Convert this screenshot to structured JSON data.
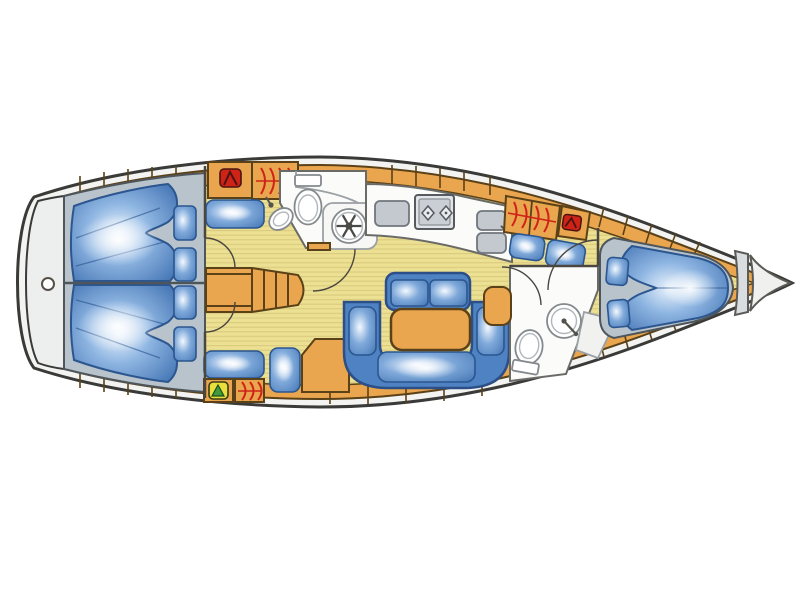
{
  "diagram": {
    "kind": "sailing-yacht-interior-floor-plan",
    "orientation": {
      "bow": "right",
      "stern": "left"
    },
    "background": "#ffffff"
  },
  "palette": {
    "hull_outline": "#3a3a38",
    "deck_white": "#f3f3f1",
    "transom_white": "#edefef",
    "cabinetry_wood": "#eaa64e",
    "wood_outline": "#5b4118",
    "floor": "#ece092",
    "floor_stripe": "#d9c87c",
    "berth_gray": "#b9c3cc",
    "berth_outline": "#4e565c",
    "duvet_outline": "#2b568f",
    "duvet_hl": "#eaf3fc",
    "duvet_mid": "#8fb6e2",
    "duvet_deep": "#3a6cae",
    "cushion_hl": "#f4f9ff",
    "cushion_mid": "#7fa9da",
    "cushion_deep": "#4678b6",
    "cushion_blue": "#4f82c2",
    "cushion_border": "#2b4f86",
    "fixture_white": "#fbfbf9",
    "fixture_outline": "#84898d",
    "wall_gray": "#6a6a66",
    "wall_dark": "#4a4640",
    "metal_gray": "#c3c9cf",
    "clothes_red": "#cf2318",
    "gear_yellow": "#e8df3e",
    "gear_green": "#3f9b3c"
  },
  "areas": [
    {
      "id": "transom-platform",
      "label": "Stern transom platform"
    },
    {
      "id": "aft-cabin-top",
      "label": "Aft double cabin (port)"
    },
    {
      "id": "aft-cabin-bottom",
      "label": "Aft double cabin (starboard)"
    },
    {
      "id": "companionway",
      "label": "Companionway steps"
    },
    {
      "id": "aft-head",
      "label": "Head with shower"
    },
    {
      "id": "nav-corner",
      "label": "Chart table corner"
    },
    {
      "id": "galley",
      "label": "Galley"
    },
    {
      "id": "salon",
      "label": "Salon with U-settee and table"
    },
    {
      "id": "forward-head",
      "label": "Forward head"
    },
    {
      "id": "forward-cabin",
      "label": "Forward V-berth cabin"
    },
    {
      "id": "bow-locker",
      "label": "Anchor locker"
    }
  ],
  "icons": [
    {
      "id": "clothes-red-icon",
      "meaning": "wardrobe with stowed clothes"
    },
    {
      "id": "hanger-arcs-icon",
      "meaning": "hanging locker rail"
    },
    {
      "id": "gear-locker-icon",
      "meaning": "gear locker"
    },
    {
      "id": "shower-icon",
      "meaning": "shower"
    },
    {
      "id": "toilet-icon",
      "meaning": "marine toilet"
    },
    {
      "id": "sink-icon",
      "meaning": "wash basin"
    },
    {
      "id": "stove-icon",
      "meaning": "two-burner stove"
    },
    {
      "id": "double-sink-icon",
      "meaning": "galley double sink"
    },
    {
      "id": "fridge-icon",
      "meaning": "icebox lid"
    }
  ]
}
